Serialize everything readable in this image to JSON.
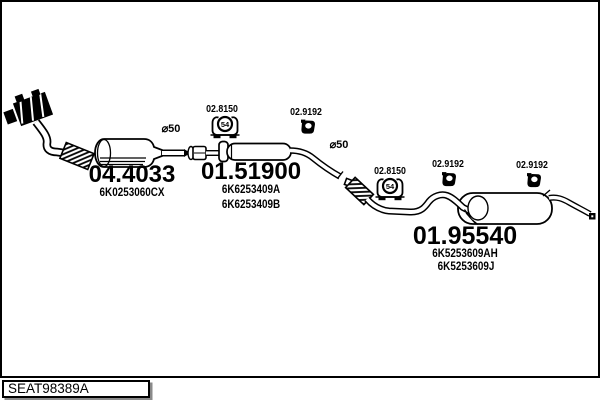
{
  "title_block": {
    "drawing_code": "SEAT98389A"
  },
  "fittings": {
    "rubber_mount": {
      "label": "02.8150",
      "size": "54"
    },
    "clamp": {
      "label": "02.9192"
    },
    "pipe_diameter": {
      "label": "⌀50"
    }
  },
  "parts": {
    "catalytic_converter": {
      "part_number": "04.4033",
      "oe_refs": [
        "6K0253060CX"
      ]
    },
    "centre_silencer": {
      "part_number": "01.51900",
      "oe_refs": [
        "6K6253409A",
        "6K6253409B"
      ]
    },
    "rear_silencer": {
      "part_number": "01.95540",
      "oe_refs": [
        "6K5253609AH",
        "6K5253609J"
      ]
    }
  }
}
